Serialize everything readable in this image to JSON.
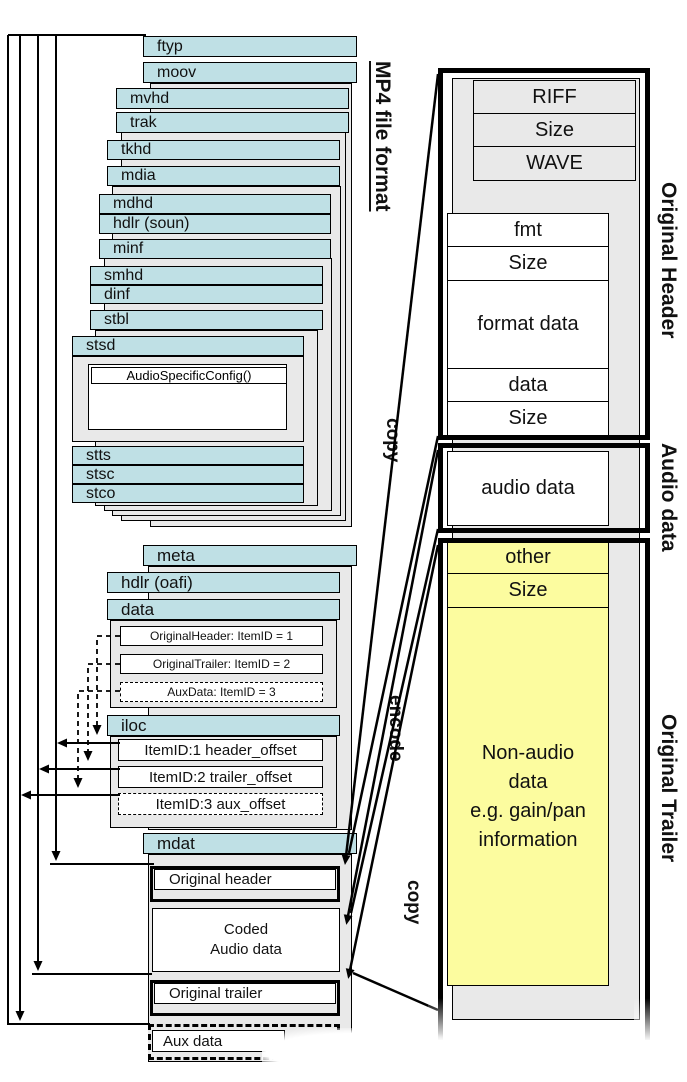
{
  "diagram_title": "MP4 file format",
  "mp4": {
    "atoms": {
      "ftyp": "ftyp",
      "moov": "moov",
      "mvhd": "mvhd",
      "trak": "trak",
      "tkhd": "tkhd",
      "mdia": "mdia",
      "mdhd": "mdhd",
      "hdlr_soun": "hdlr (soun)",
      "minf": "minf",
      "smhd": "smhd",
      "dinf": "dinf",
      "stbl": "stbl",
      "stsd": "stsd",
      "stts": "stts",
      "stsc": "stsc",
      "stco": "stco",
      "meta": "meta",
      "hdlr_oafi": "hdlr (oafi)",
      "data": "data",
      "iloc": "iloc",
      "mdat": "mdat"
    },
    "audio_specific_config": "AudioSpecificConfig()",
    "data_items": [
      "OriginalHeader: ItemID = 1",
      "OriginalTrailer: ItemID = 2",
      "AuxData: ItemID = 3"
    ],
    "iloc_items": [
      "ItemID:1 header_offset",
      "ItemID:2 trailer_offset",
      "ItemID:3 aux_offset"
    ],
    "mdat_items": {
      "original_header": "Original header",
      "coded_audio_line1": "Coded",
      "coded_audio_line2": "Audio data",
      "original_trailer": "Original trailer",
      "aux_data": "Aux data"
    }
  },
  "wav": {
    "riff_rows": [
      "RIFF",
      "Size",
      "WAVE"
    ],
    "fmt_rows": [
      "fmt",
      "Size",
      "format data",
      "data",
      "Size"
    ],
    "audio_row": "audio data",
    "trailer_rows": [
      "other",
      "Size"
    ],
    "non_audio_lines": [
      "Non-audio",
      "data",
      "e.g. gain/pan",
      "information"
    ],
    "section_labels": {
      "header": "Original Header",
      "audio": "Audio data",
      "trailer": "Original Trailer"
    }
  },
  "connector_labels": {
    "copy_top": "copy",
    "encode": "encode",
    "copy_bottom": "copy"
  },
  "colors": {
    "atom_teal": "#bfe0e5",
    "container_grey": "#e9e9e9",
    "trailer_yellow": "#fcfc9f",
    "line_black": "#000000"
  }
}
